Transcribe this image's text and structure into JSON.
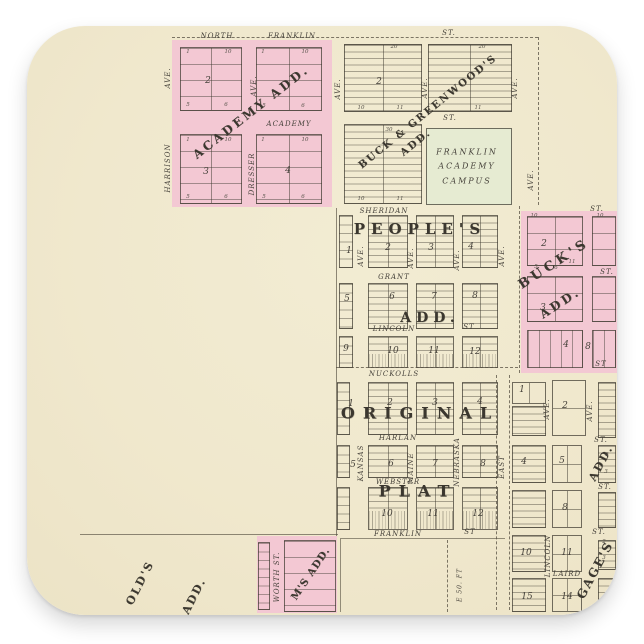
{
  "canvas": {
    "width": 644,
    "height": 644,
    "background": "#ffffff"
  },
  "sticker": {
    "shape": "rounded-square",
    "background": "#f0e8cd",
    "corner_radius_px": 58
  },
  "colors": {
    "addition_pink": "#f3c8d3",
    "campus_green": "#e6ebd2",
    "ink": "#45413a",
    "paper": "#f0e8cd"
  },
  "map": {
    "labels": [
      {
        "name": "street-north",
        "text": "NORTH",
        "x": 217,
        "y": 36,
        "cls": "st"
      },
      {
        "name": "street-franklin-north",
        "text": "FRANKLIN",
        "x": 292,
        "y": 36,
        "cls": "st"
      },
      {
        "name": "street-st-top",
        "text": "ST.",
        "x": 449,
        "y": 33,
        "cls": "st"
      },
      {
        "name": "street-academy",
        "text": "ACADEMY",
        "x": 289,
        "y": 124,
        "cls": "st"
      },
      {
        "name": "street-st-mid",
        "text": "ST.",
        "x": 450,
        "y": 118,
        "cls": "st"
      },
      {
        "name": "street-sheridan",
        "text": "SHERIDAN",
        "x": 384,
        "y": 211,
        "cls": "st"
      },
      {
        "name": "street-grant",
        "text": "GRANT",
        "x": 394,
        "y": 277,
        "cls": "st"
      },
      {
        "name": "street-lincoln",
        "text": "LINCOLN",
        "x": 394,
        "y": 329,
        "cls": "st"
      },
      {
        "name": "street-lincoln-st",
        "text": "ST",
        "x": 469,
        "y": 327,
        "cls": "st"
      },
      {
        "name": "street-nuckolls",
        "text": "NUCKOLLS",
        "x": 394,
        "y": 374,
        "cls": "st"
      },
      {
        "name": "street-harlan",
        "text": "HARLAN",
        "x": 398,
        "y": 438,
        "cls": "st"
      },
      {
        "name": "street-webster",
        "text": "WEBSTER",
        "x": 398,
        "y": 482,
        "cls": "st"
      },
      {
        "name": "street-franklin-south",
        "text": "FRANKLIN",
        "x": 398,
        "y": 534,
        "cls": "st"
      },
      {
        "name": "street-franklin-st",
        "text": "ST",
        "x": 470,
        "y": 532,
        "cls": "st"
      },
      {
        "name": "street-laird",
        "text": "LAIRD",
        "x": 567,
        "y": 574,
        "cls": "st"
      },
      {
        "name": "street-st-bucks-top",
        "text": "ST.",
        "x": 597,
        "y": 209,
        "cls": "st"
      },
      {
        "name": "street-st-bucks-mid",
        "text": "ST.",
        "x": 607,
        "y": 272,
        "cls": "st"
      },
      {
        "name": "street-st-bucks-bot",
        "text": "ST",
        "x": 601,
        "y": 364,
        "cls": "st"
      },
      {
        "name": "street-st-gages-1",
        "text": "ST.",
        "x": 601,
        "y": 440,
        "cls": "st"
      },
      {
        "name": "street-st-gages-2",
        "text": "ST.",
        "x": 605,
        "y": 487,
        "cls": "st"
      },
      {
        "name": "street-st-gages-3",
        "text": "ST.",
        "x": 599,
        "y": 532,
        "cls": "st"
      },
      {
        "name": "avenue-harrison-ave",
        "text": "AVE.",
        "x": 168,
        "y": 78,
        "r": -90,
        "cls": "st"
      },
      {
        "name": "avenue-harrison",
        "text": "HARRISON",
        "x": 168,
        "y": 168,
        "r": -90,
        "cls": "st"
      },
      {
        "name": "avenue-dresser-ave",
        "text": "AVE.",
        "x": 254,
        "y": 86,
        "r": -90,
        "cls": "st"
      },
      {
        "name": "avenue-dresser",
        "text": "DRESSER",
        "x": 252,
        "y": 174,
        "r": -90,
        "cls": "st"
      },
      {
        "name": "avenue-bg-left",
        "text": "AVE.",
        "x": 338,
        "y": 89,
        "r": -90,
        "cls": "st"
      },
      {
        "name": "avenue-bg-mid",
        "text": "AVE.",
        "x": 425,
        "y": 88,
        "r": -90,
        "cls": "st"
      },
      {
        "name": "avenue-bg-right",
        "text": "AVE.",
        "x": 515,
        "y": 88,
        "r": -90,
        "cls": "st"
      },
      {
        "name": "avenue-right-edge",
        "text": "AVE.",
        "x": 531,
        "y": 180,
        "r": -90,
        "cls": "st"
      },
      {
        "name": "avenue-peoples-1",
        "text": "AVE.",
        "x": 361,
        "y": 256,
        "r": -90,
        "cls": "st"
      },
      {
        "name": "avenue-peoples-2",
        "text": "AVE.",
        "x": 411,
        "y": 258,
        "r": -90,
        "cls": "st"
      },
      {
        "name": "avenue-peoples-3",
        "text": "AVE.",
        "x": 457,
        "y": 260,
        "r": -90,
        "cls": "st"
      },
      {
        "name": "avenue-peoples-4",
        "text": "AVE.",
        "x": 502,
        "y": 256,
        "r": -90,
        "cls": "st"
      },
      {
        "name": "avenue-kansas",
        "text": "KANSAS",
        "x": 361,
        "y": 463,
        "r": -90,
        "cls": "st"
      },
      {
        "name": "avenue-maine",
        "text": "MAINE",
        "x": 411,
        "y": 468,
        "r": -90,
        "cls": "st"
      },
      {
        "name": "avenue-nebraska",
        "text": "NEBRASKA",
        "x": 457,
        "y": 462,
        "r": -90,
        "cls": "st"
      },
      {
        "name": "avenue-east",
        "text": "EAST",
        "x": 502,
        "y": 467,
        "r": -90,
        "cls": "st"
      },
      {
        "name": "street-lincoln-vertical",
        "text": "LINCOLN",
        "x": 548,
        "y": 556,
        "r": -90,
        "cls": "st"
      },
      {
        "name": "street-worth",
        "text": "WORTH ST.",
        "x": 277,
        "y": 577,
        "r": -90,
        "cls": "st"
      },
      {
        "name": "avenue-gages-1",
        "text": "AVE.",
        "x": 547,
        "y": 409,
        "r": -90,
        "cls": "st"
      },
      {
        "name": "avenue-gages-2",
        "text": "AVE.",
        "x": 590,
        "y": 411,
        "r": -90,
        "cls": "st"
      },
      {
        "name": "note-e50ft",
        "text": "E 50. FT",
        "x": 460,
        "y": 585,
        "r": -90,
        "cls": "st",
        "fs": 6
      },
      {
        "name": "addition-academy",
        "text": "ACADEMY ADD.",
        "x": 251,
        "y": 112,
        "r": -38,
        "cls": "fancy",
        "fs": 12,
        "sp": 3
      },
      {
        "name": "addition-buck-greenwood",
        "text": "BUCK & GREENWOOD'S",
        "x": 428,
        "y": 112,
        "r": -39,
        "cls": "fancy",
        "fs": 10,
        "sp": 2
      },
      {
        "name": "addition-buck-greenwood-add",
        "text": "ADD.",
        "x": 416,
        "y": 143,
        "r": -39,
        "cls": "fancy",
        "fs": 10,
        "sp": 2
      },
      {
        "name": "addition-peoples",
        "text": "PEOPLE'S",
        "x": 420,
        "y": 229,
        "cls": "fancy",
        "fs": 15,
        "sp": 6
      },
      {
        "name": "addition-peoples-add",
        "text": "ADD.",
        "x": 430,
        "y": 318,
        "cls": "fancy",
        "fs": 14,
        "sp": 5
      },
      {
        "name": "addition-bucks",
        "text": "BUCK'S",
        "x": 554,
        "y": 264,
        "r": -33,
        "cls": "fancy",
        "fs": 13,
        "sp": 4
      },
      {
        "name": "addition-bucks-add",
        "text": "ADD.",
        "x": 560,
        "y": 303,
        "r": -33,
        "cls": "fancy",
        "fs": 12,
        "sp": 3
      },
      {
        "name": "addition-original",
        "text": "ORIGINAL",
        "x": 420,
        "y": 413,
        "cls": "fancy",
        "fs": 16,
        "sp": 8
      },
      {
        "name": "addition-plat",
        "text": "PLAT",
        "x": 418,
        "y": 491,
        "cls": "fancy",
        "fs": 16,
        "sp": 8
      },
      {
        "name": "addition-gages",
        "text": "GAGE'S",
        "x": 595,
        "y": 570,
        "r": -62,
        "cls": "fancy",
        "fs": 12,
        "sp": 2
      },
      {
        "name": "addition-gages-add",
        "text": "ADD.",
        "x": 601,
        "y": 463,
        "r": -62,
        "cls": "fancy",
        "fs": 11,
        "sp": 2
      },
      {
        "name": "addition-fragment-olds",
        "text": "OLD'S",
        "x": 140,
        "y": 583,
        "r": -63,
        "cls": "fancy",
        "fs": 11,
        "sp": 2
      },
      {
        "name": "addition-fragment-olds-add",
        "text": "ADD.",
        "x": 194,
        "y": 596,
        "r": -63,
        "cls": "fancy",
        "fs": 11,
        "sp": 2
      },
      {
        "name": "addition-fragment-ms-add",
        "text": "M'S ADD.",
        "x": 311,
        "y": 574,
        "r": -56,
        "cls": "fancy",
        "fs": 10,
        "sp": 1
      },
      {
        "name": "campus-line-1",
        "text": "FRANKLIN",
        "x": 467,
        "y": 152,
        "cls": "campus"
      },
      {
        "name": "campus-line-2",
        "text": "ACADEMY",
        "x": 467,
        "y": 166,
        "cls": "campus"
      },
      {
        "name": "campus-line-3",
        "text": "CAMPUS",
        "x": 467,
        "y": 181,
        "cls": "campus"
      },
      {
        "name": "block-academy-2",
        "text": "2",
        "x": 208,
        "y": 81,
        "cls": "bn"
      },
      {
        "name": "block-academy-3",
        "text": "3",
        "x": 206,
        "y": 172,
        "cls": "bn"
      },
      {
        "name": "block-academy-4",
        "text": "4",
        "x": 288,
        "y": 171,
        "cls": "bn"
      },
      {
        "name": "block-bg-2",
        "text": "2",
        "x": 379,
        "y": 82,
        "cls": "bn"
      },
      {
        "name": "block-peoples-1",
        "text": "1",
        "x": 349,
        "y": 251,
        "cls": "bn"
      },
      {
        "name": "block-peoples-2",
        "text": "2",
        "x": 388,
        "y": 248,
        "cls": "bn"
      },
      {
        "name": "block-peoples-3",
        "text": "3",
        "x": 431,
        "y": 248,
        "cls": "bn"
      },
      {
        "name": "block-peoples-4",
        "text": "4",
        "x": 471,
        "y": 247,
        "cls": "bn"
      },
      {
        "name": "block-peoples-5",
        "text": "5",
        "x": 347,
        "y": 299,
        "cls": "bn"
      },
      {
        "name": "block-peoples-6",
        "text": "6",
        "x": 392,
        "y": 297,
        "cls": "bn"
      },
      {
        "name": "block-peoples-7",
        "text": "7",
        "x": 434,
        "y": 297,
        "cls": "bn"
      },
      {
        "name": "block-peoples-8",
        "text": "8",
        "x": 475,
        "y": 296,
        "cls": "bn"
      },
      {
        "name": "block-peoples-9",
        "text": "9",
        "x": 346,
        "y": 349,
        "cls": "bn"
      },
      {
        "name": "block-peoples-10",
        "text": "10",
        "x": 393,
        "y": 351,
        "cls": "bn"
      },
      {
        "name": "block-peoples-11",
        "text": "11",
        "x": 434,
        "y": 351,
        "cls": "bn"
      },
      {
        "name": "block-peoples-12",
        "text": "12",
        "x": 475,
        "y": 352,
        "cls": "bn"
      },
      {
        "name": "block-bucks-2",
        "text": "2",
        "x": 544,
        "y": 244,
        "cls": "bn"
      },
      {
        "name": "block-bucks-3",
        "text": "3",
        "x": 543,
        "y": 308,
        "cls": "bn"
      },
      {
        "name": "block-bucks-4",
        "text": "4",
        "x": 566,
        "y": 345,
        "cls": "bn"
      },
      {
        "name": "block-bucks-8",
        "text": "8",
        "x": 588,
        "y": 347,
        "cls": "bn"
      },
      {
        "name": "block-original-1",
        "text": "1",
        "x": 351,
        "y": 404,
        "cls": "bn"
      },
      {
        "name": "block-original-2",
        "text": "2",
        "x": 390,
        "y": 403,
        "cls": "bn"
      },
      {
        "name": "block-original-3",
        "text": "3",
        "x": 435,
        "y": 403,
        "cls": "bn"
      },
      {
        "name": "block-original-4",
        "text": "4",
        "x": 480,
        "y": 402,
        "cls": "bn"
      },
      {
        "name": "block-original-5",
        "text": "5",
        "x": 353,
        "y": 465,
        "cls": "bn"
      },
      {
        "name": "block-original-6",
        "text": "6",
        "x": 391,
        "y": 464,
        "cls": "bn"
      },
      {
        "name": "block-original-7",
        "text": "7",
        "x": 435,
        "y": 464,
        "cls": "bn"
      },
      {
        "name": "block-original-8",
        "text": "8",
        "x": 483,
        "y": 464,
        "cls": "bn"
      },
      {
        "name": "block-original-10",
        "text": "10",
        "x": 387,
        "y": 514,
        "cls": "bn"
      },
      {
        "name": "block-original-11",
        "text": "11",
        "x": 433,
        "y": 514,
        "cls": "bn"
      },
      {
        "name": "block-original-12",
        "text": "12",
        "x": 478,
        "y": 514,
        "cls": "bn"
      },
      {
        "name": "block-gages-1",
        "text": "1",
        "x": 522,
        "y": 390,
        "cls": "bn"
      },
      {
        "name": "block-gages-2",
        "text": "2",
        "x": 565,
        "y": 406,
        "cls": "bn"
      },
      {
        "name": "block-gages-4",
        "text": "4",
        "x": 524,
        "y": 462,
        "cls": "bn"
      },
      {
        "name": "block-gages-5",
        "text": "5",
        "x": 562,
        "y": 461,
        "cls": "bn"
      },
      {
        "name": "block-gages-8",
        "text": "8",
        "x": 565,
        "y": 508,
        "cls": "bn"
      },
      {
        "name": "block-gages-10",
        "text": "10",
        "x": 526,
        "y": 553,
        "cls": "bn"
      },
      {
        "name": "block-gages-11",
        "text": "11",
        "x": 567,
        "y": 553,
        "cls": "bn"
      },
      {
        "name": "block-gages-15",
        "text": "15",
        "x": 527,
        "y": 597,
        "cls": "bn"
      },
      {
        "name": "block-gages-14",
        "text": "14",
        "x": 567,
        "y": 597,
        "cls": "bn"
      },
      {
        "name": "lot-number",
        "text": "1",
        "x": 188,
        "y": 52,
        "cls": "ln"
      },
      {
        "name": "lot-number",
        "text": "10",
        "x": 228,
        "y": 52,
        "cls": "ln"
      },
      {
        "name": "lot-number",
        "text": "5",
        "x": 188,
        "y": 105,
        "cls": "ln"
      },
      {
        "name": "lot-number",
        "text": "6",
        "x": 226,
        "y": 105,
        "cls": "ln"
      },
      {
        "name": "lot-number",
        "text": "1",
        "x": 263,
        "y": 52,
        "cls": "ln"
      },
      {
        "name": "lot-number",
        "text": "10",
        "x": 305,
        "y": 52,
        "cls": "ln"
      },
      {
        "name": "lot-number",
        "text": "5",
        "x": 264,
        "y": 106,
        "cls": "ln"
      },
      {
        "name": "lot-number",
        "text": "6",
        "x": 303,
        "y": 106,
        "cls": "ln"
      },
      {
        "name": "lot-number",
        "text": "1",
        "x": 188,
        "y": 140,
        "cls": "ln"
      },
      {
        "name": "lot-number",
        "text": "10",
        "x": 228,
        "y": 140,
        "cls": "ln"
      },
      {
        "name": "lot-number",
        "text": "5",
        "x": 188,
        "y": 197,
        "cls": "ln"
      },
      {
        "name": "lot-number",
        "text": "6",
        "x": 226,
        "y": 197,
        "cls": "ln"
      },
      {
        "name": "lot-number",
        "text": "1",
        "x": 263,
        "y": 140,
        "cls": "ln"
      },
      {
        "name": "lot-number",
        "text": "10",
        "x": 305,
        "y": 140,
        "cls": "ln"
      },
      {
        "name": "lot-number",
        "text": "5",
        "x": 264,
        "y": 197,
        "cls": "ln"
      },
      {
        "name": "lot-number",
        "text": "6",
        "x": 303,
        "y": 197,
        "cls": "ln"
      },
      {
        "name": "lot-number",
        "text": "20",
        "x": 394,
        "y": 47,
        "cls": "ln"
      },
      {
        "name": "lot-number",
        "text": "20",
        "x": 482,
        "y": 47,
        "cls": "ln"
      },
      {
        "name": "lot-number",
        "text": "10",
        "x": 361,
        "y": 108,
        "cls": "ln"
      },
      {
        "name": "lot-number",
        "text": "11",
        "x": 400,
        "y": 108,
        "cls": "ln"
      },
      {
        "name": "lot-number",
        "text": "11",
        "x": 478,
        "y": 108,
        "cls": "ln"
      },
      {
        "name": "lot-number",
        "text": "30",
        "x": 389,
        "y": 130,
        "cls": "ln"
      },
      {
        "name": "lot-number",
        "text": "10",
        "x": 361,
        "y": 199,
        "cls": "ln"
      },
      {
        "name": "lot-number",
        "text": "11",
        "x": 400,
        "y": 199,
        "cls": "ln"
      },
      {
        "name": "lot-number",
        "text": "10",
        "x": 534,
        "y": 216,
        "cls": "ln"
      },
      {
        "name": "lot-number",
        "text": "10",
        "x": 600,
        "y": 216,
        "cls": "ln"
      },
      {
        "name": "lot-number",
        "text": "5",
        "x": 536,
        "y": 267,
        "cls": "ln"
      },
      {
        "name": "lot-number",
        "text": "6",
        "x": 556,
        "y": 268,
        "cls": "ln"
      },
      {
        "name": "lot-number",
        "text": "11",
        "x": 572,
        "y": 262,
        "cls": "ln"
      },
      {
        "name": "lot-number",
        "text": "2",
        "x": 607,
        "y": 455,
        "cls": "ln"
      },
      {
        "name": "lot-number",
        "text": "3",
        "x": 606,
        "y": 472,
        "cls": "ln"
      },
      {
        "name": "lot-number",
        "text": "2",
        "x": 604,
        "y": 542,
        "cls": "ln"
      },
      {
        "name": "lot-number",
        "text": "3",
        "x": 604,
        "y": 558,
        "cls": "ln"
      }
    ]
  }
}
